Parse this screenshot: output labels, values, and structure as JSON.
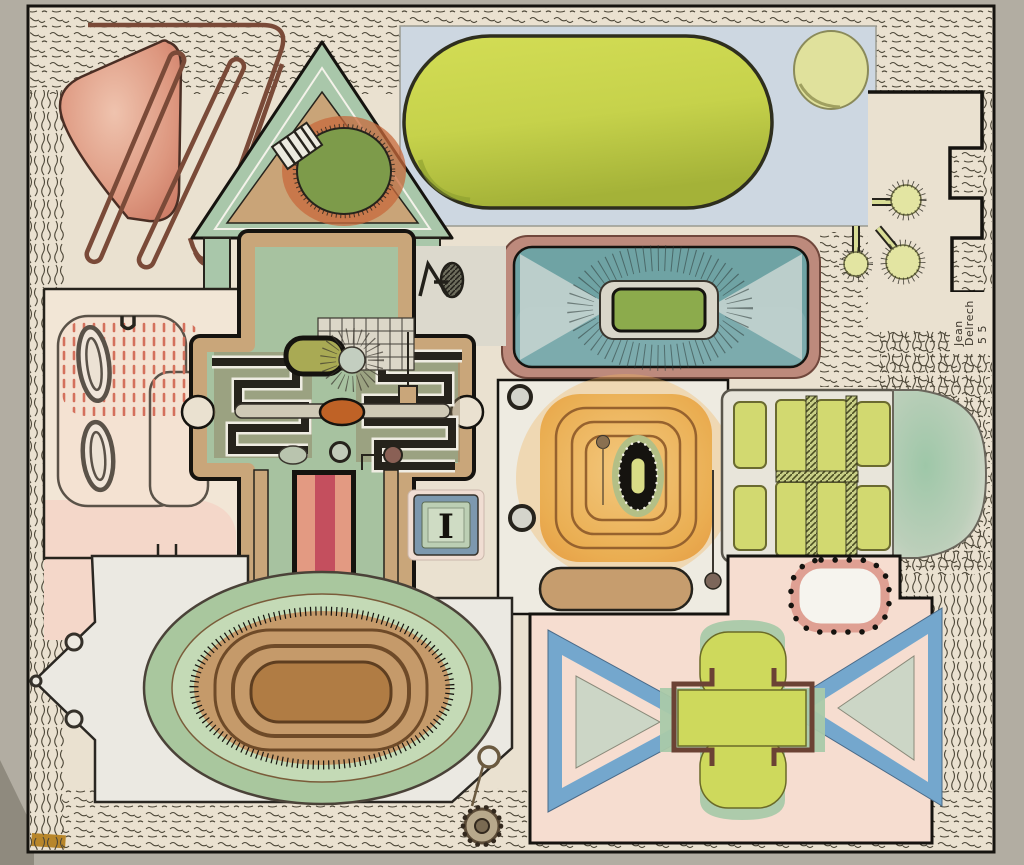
{
  "artwork": {
    "kind": "abstract watercolor plan painting (photographed)",
    "signature": {
      "line1": "Jean",
      "line2": "Delrech",
      "line3": "5 5"
    },
    "marking_i": "I"
  },
  "palette": {
    "photo_margin": "#b2ada2",
    "paper": "#eae1d0",
    "ink": "#15130f",
    "salmon_triangle": "#d98b77",
    "hairpin_brown": "#7a4a38",
    "sage_green": "#a7c2a0",
    "tan": "#c9a67a",
    "dark_green_oval": "#7d9b4a",
    "chartreuse_pill": "#c6d24b",
    "blue_panel": "#cdd7e1",
    "teal_screen": "#6fa3a4",
    "screen_green": "#8cab4c",
    "orange_target": "#e8a94c",
    "piston_red": "#c4505e",
    "piston_salmon": "#e39a82",
    "pink_wash": "#f4d7c9",
    "window_pane": "#d2d970",
    "triangle_blue": "#74a7cd",
    "cross_yellow": "#ced95c",
    "cross_frame_brown": "#6b4234",
    "oval_brown": "#b07c44",
    "i_tile_blue": "#7d98ae"
  }
}
